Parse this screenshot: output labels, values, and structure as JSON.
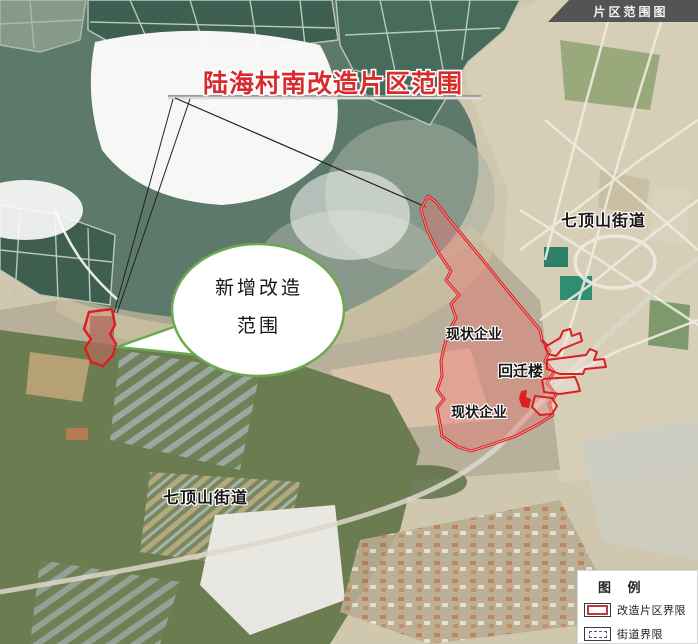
{
  "banner": {
    "label": "片区范围图"
  },
  "annotations": {
    "title": "陆海村南改造片区范围",
    "callout": {
      "line1": "新增改造",
      "line2": "范围"
    },
    "labels": [
      {
        "id": "street-ne",
        "text": "七顶山街道"
      },
      {
        "id": "street-sw",
        "text": "七顶山街道"
      },
      {
        "id": "enterprise-top",
        "text": "现状企业"
      },
      {
        "id": "enterprise-bottom",
        "text": "现状企业"
      },
      {
        "id": "relocation-building",
        "text": "回迁楼"
      }
    ]
  },
  "legend": {
    "title": "图 例",
    "items": [
      {
        "label": "改造片区界限",
        "swatch": "red-rect"
      },
      {
        "label": "街道界限",
        "swatch": "dashed-rect"
      }
    ]
  },
  "colors": {
    "boundary_red": "#d92121",
    "boundary_fill": "rgba(236,110,110,0.38)",
    "callout_green": "#6aaa4e",
    "title_red": "#d92b2b",
    "banner_bg": "#4a4a4a",
    "legend_dash_blue": "#4a5a7a",
    "water_teal": "#5c796c"
  }
}
